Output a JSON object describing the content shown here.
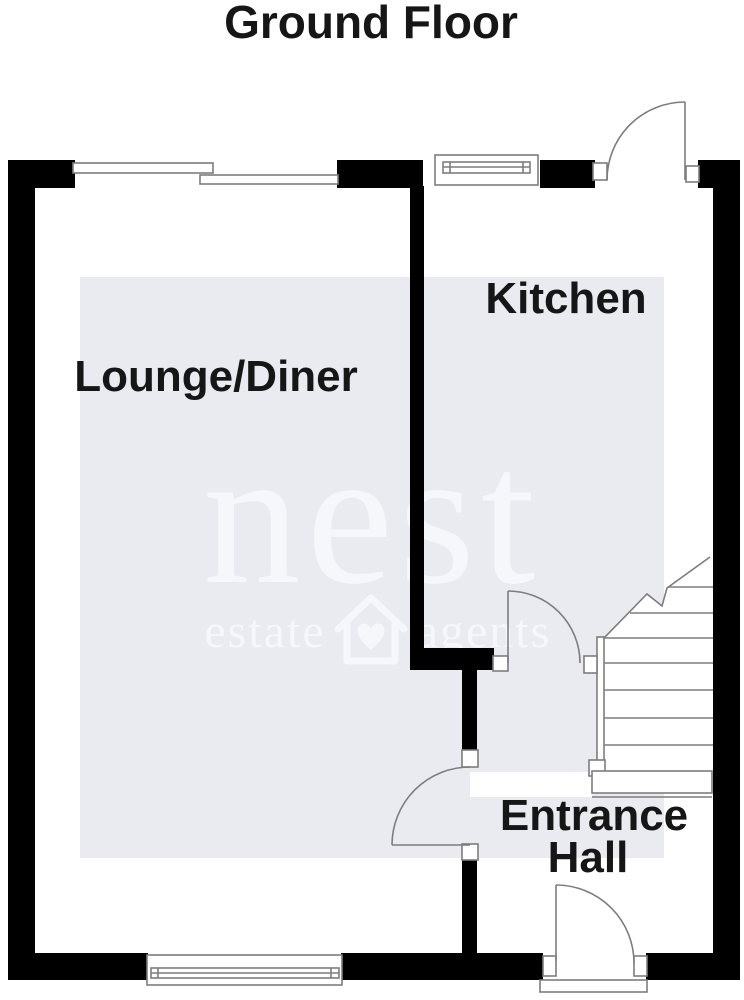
{
  "title": "Ground Floor",
  "labels": {
    "lounge": "Lounge/Diner",
    "kitchen": "Kitchen",
    "entrance_line1": "Entrance",
    "entrance_line2": "Hall"
  },
  "watermark": {
    "brand": "nest",
    "word_left": "estate",
    "word_right": "agents",
    "logo_icon": "house-with-heart-icon"
  },
  "colors": {
    "wall": "#000000",
    "line": "#7d7d7d",
    "room_fill": "#e9ebf0",
    "watermark": "#f5f7fa",
    "ink": "#161616",
    "paper": "#ffffff"
  }
}
